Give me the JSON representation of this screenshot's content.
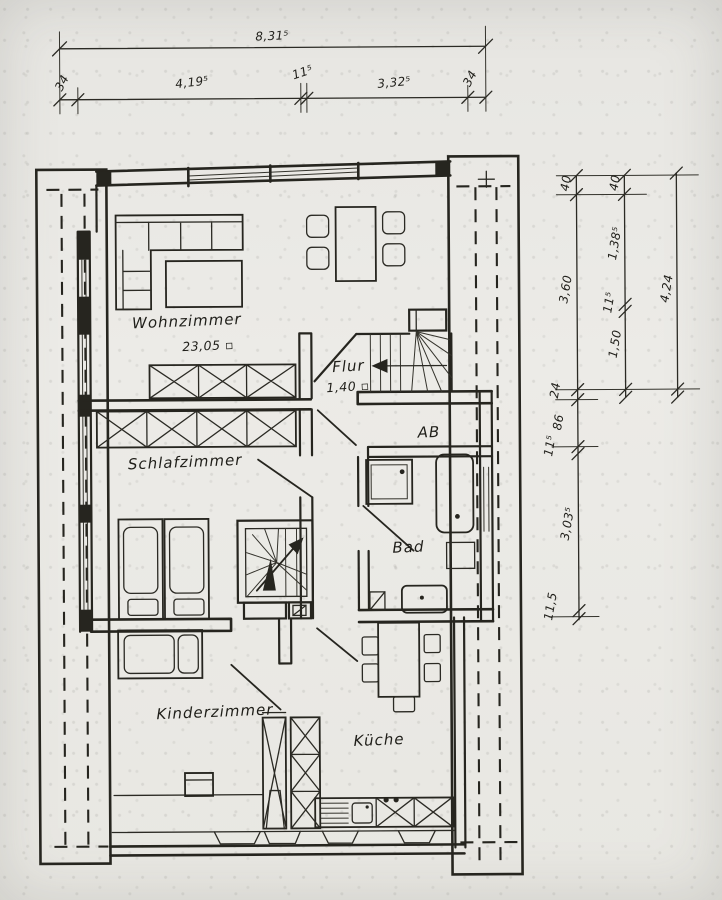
{
  "drawing": {
    "kind": "apartment floor plan, scanned hand drawing"
  },
  "rooms": {
    "wohnzimmer": {
      "name": "Wohnzimmer",
      "area": "23,05 ▫"
    },
    "flur": {
      "name": "Flur",
      "width": "1,40 ▫"
    },
    "ab": {
      "name": "AB"
    },
    "schlafzimmer": {
      "name": "Schlafzimmer"
    },
    "bad": {
      "name": "Bad"
    },
    "kinderzimmer": {
      "name": "Kinderzimmer"
    },
    "kueche": {
      "name": "Küche"
    }
  },
  "dimensions": {
    "top": {
      "total": "8,31⁵",
      "left_offset": "34",
      "seg1": "4,19⁵",
      "mid": "11⁵",
      "seg2": "3,32⁵",
      "right_offset": "34"
    },
    "right": {
      "col_inner": {
        "v1": "40",
        "v2": "3,60",
        "v3": "24",
        "v4": "86",
        "v5": "11⁵",
        "v6": "3,03⁵",
        "v7": "11,5"
      },
      "col_mid": {
        "v1": "40",
        "v2": "1,38⁵",
        "v3": "11⁵",
        "v4": "1,50"
      },
      "col_outer": {
        "v1": "4,24"
      }
    }
  },
  "colors": {
    "ink": "#26251f",
    "paper": "#eae9e5"
  }
}
